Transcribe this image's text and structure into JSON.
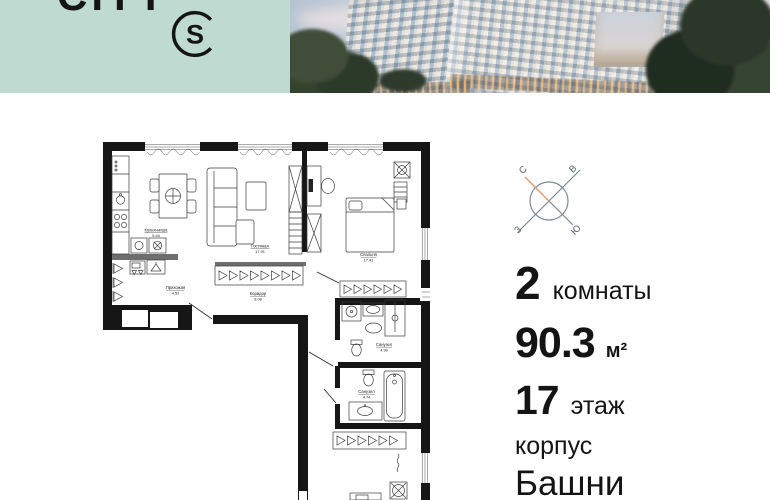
{
  "header": {
    "brand_text": "CITY",
    "logo_letter": "S"
  },
  "compass": {
    "north": "С",
    "east": "В",
    "west": "З",
    "south": "Ю"
  },
  "details": {
    "rooms_value": "2",
    "rooms_label": "комнаты",
    "area_value": "90.3",
    "area_unit": "м²",
    "floor_value": "17",
    "floor_label": "этаж",
    "building_label": "корпус",
    "building_value": "Башни"
  },
  "plan": {
    "rooms": [
      {
        "name": "Кухня-ниша",
        "area": "5.44"
      },
      {
        "name": "Гостиная",
        "area": "17.91"
      },
      {
        "name": "Спальня",
        "area": "17.41"
      },
      {
        "name": "Прихожая",
        "area": "4.52"
      },
      {
        "name": "Коридор",
        "area": "8.08"
      },
      {
        "name": "Санузел",
        "area": "4.99"
      },
      {
        "name": "Санузел",
        "area": "4.74"
      }
    ]
  },
  "colors": {
    "accent_teal": "#bedad1",
    "compass_orange": "#e59a70",
    "wall_black": "#161616"
  }
}
